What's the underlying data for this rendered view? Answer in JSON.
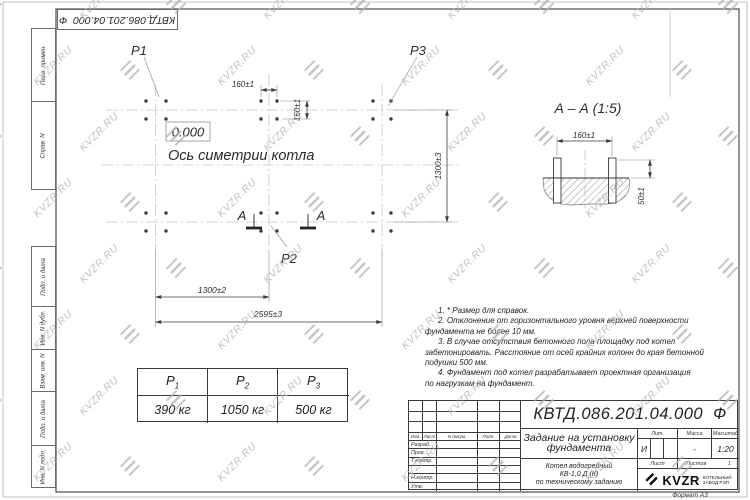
{
  "watermark": {
    "text": "KVZR.RU"
  },
  "frame": {
    "top_box_designation": "КВТД.086.201.04.000",
    "top_box_suffix": "Ф",
    "left_cells": [
      "Перв. примен.",
      "Справ. N",
      "Подп. и дата",
      "Инв. N дубл.",
      "Взам. инв. N",
      "Подп. и дата",
      "Инв. N подл."
    ],
    "format_note": "Формат А3"
  },
  "plan": {
    "label_p1": "Р1",
    "label_p2": "Р2",
    "label_p3": "Р3",
    "elevation": "0.000",
    "axis_label": "Ось симетрии котла",
    "dim_bolt_pitch_top": "160±1",
    "dim_bolt_pitch_side": "160±1",
    "dim_width_right": "1300±3",
    "dim_half_length": "1300±2",
    "dim_full_length": "2595±3",
    "section_mark_left": "А",
    "section_mark_right": "А"
  },
  "section_view": {
    "title": "А – А (1:5)",
    "dim_bolt_pitch": "160±1",
    "dim_protrusion": "50±1"
  },
  "load_table": {
    "columns": [
      {
        "symbol": "Р",
        "index": "1",
        "value": "390 кг"
      },
      {
        "symbol": "Р",
        "index": "2",
        "value": "1050 кг"
      },
      {
        "symbol": "Р",
        "index": "3",
        "value": "500 кг"
      }
    ]
  },
  "notes": {
    "lines": [
      "1. * Размер для справок.",
      "2. Отклонение от горизонтального уровня верхней поверхности",
      "фундамента не более 10 мм.",
      "3. В случае отсутствия бетонного пола площадку под котел",
      "забетонировать. Расстояние от осей крайних колонн до края бетонной",
      "подушки 500 мм.",
      "4. Фундамент под котел разрабатывает проектная организация",
      "по нагрузкам на фундамент."
    ]
  },
  "title_block": {
    "designation": "КВТД.086.201.04.000",
    "designation_suffix": "Ф",
    "doc_title": "Задание на установку фундамента",
    "product": [
      "Котел водогрейный",
      "КВ-1,0 Д (К)",
      "по техническому заданию"
    ],
    "col_headers": [
      "Изм.",
      "Лист",
      "N докум.",
      "Подп.",
      "Дата"
    ],
    "row_labels": [
      "Разраб.",
      "Пров.",
      "Т.контр.",
      "",
      "Н.контр.",
      "Утв."
    ],
    "lit_header": "Лит.",
    "mass_header": "Масса",
    "scale_header": "Масштаб",
    "lit_value": "И",
    "mass_value": "-",
    "scale_value": "1:20",
    "sheet_label": "Лист",
    "sheets_label": "Листов",
    "sheets_value": "1",
    "logo_text": "KVZR",
    "logo_caption": [
      "КОТЕЛЬНЫЙ",
      "ЗАВОД РЭП"
    ]
  }
}
